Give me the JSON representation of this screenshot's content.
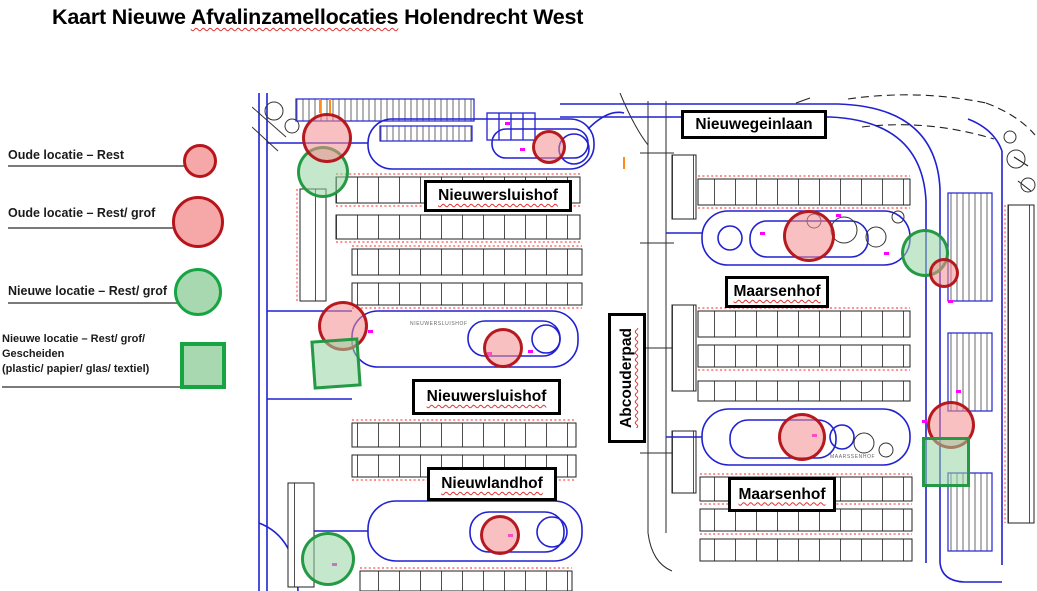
{
  "title": {
    "prefix": "Kaart Nieuwe ",
    "misspelled": "Afvalinzamellocaties",
    "suffix": " Holendrecht West"
  },
  "legend": {
    "items": [
      {
        "label": "Oude locatie – Rest",
        "shape": "circle",
        "size": "small",
        "color": "red"
      },
      {
        "label": "Oude locatie – Rest/ grof",
        "shape": "circle",
        "size": "large",
        "color": "red"
      },
      {
        "label": "Nieuwe locatie – Rest/ grof",
        "shape": "circle",
        "size": "large",
        "color": "green"
      },
      {
        "lines": [
          "Nieuwe locatie – Rest/ grof/",
          "Gescheiden",
          "(plastic/ papier/ glas/ textiel)"
        ],
        "shape": "square",
        "color": "green"
      }
    ]
  },
  "colors": {
    "old_location_stroke": "#b6161b",
    "old_location_fill": "#f6a8a8",
    "new_location_stroke": "#17a544",
    "new_location_fill": "#a8d8b0",
    "road_blue": "#2121d2",
    "dimension_red": "#ff2222",
    "annotation_magenta": "#ff00ff",
    "spellcheck_red": "#e03131"
  },
  "map": {
    "street_labels": [
      {
        "text": "Nieuwegeinlaan",
        "x": 681,
        "y": 110,
        "w": 146,
        "h": 29,
        "misspelled": false,
        "vertical": false
      },
      {
        "text": "Nieuwersluishof",
        "x": 424,
        "y": 180,
        "w": 148,
        "h": 32,
        "misspelled": true,
        "vertical": false
      },
      {
        "text": "Nieuwersluishof",
        "x": 412,
        "y": 379,
        "w": 149,
        "h": 36,
        "misspelled": true,
        "vertical": false
      },
      {
        "text": "Abcouderpad",
        "x": 608,
        "y": 313,
        "w": 38,
        "h": 130,
        "misspelled": true,
        "vertical": true
      },
      {
        "text": "Maarsenhof",
        "x": 725,
        "y": 276,
        "w": 104,
        "h": 32,
        "misspelled": true,
        "vertical": false
      },
      {
        "text": "Nieuwlandhof",
        "x": 427,
        "y": 467,
        "w": 130,
        "h": 34,
        "misspelled": true,
        "vertical": false
      },
      {
        "text": "Maarsenhof",
        "x": 728,
        "y": 477,
        "w": 108,
        "h": 35,
        "misspelled": true,
        "vertical": false
      }
    ],
    "micro_labels": [
      {
        "text": "MAARSSENHOF",
        "x": 830,
        "y": 454
      },
      {
        "text": "NIEUWERSLUISHOF",
        "x": 410,
        "y": 321
      }
    ],
    "markers": [
      {
        "name": "new-location-rest-grof",
        "shape": "circle",
        "color": "green",
        "cx": 323,
        "cy": 172,
        "r": 26
      },
      {
        "name": "old-location-rest-grof",
        "shape": "circle",
        "color": "red",
        "cx": 327,
        "cy": 138,
        "r": 25
      },
      {
        "name": "old-location-rest",
        "shape": "circle",
        "color": "red",
        "cx": 549,
        "cy": 147,
        "r": 17
      },
      {
        "name": "old-location-rest-grof",
        "shape": "circle",
        "color": "red",
        "cx": 809,
        "cy": 236,
        "r": 26
      },
      {
        "name": "new-location-rest-grof",
        "shape": "circle",
        "color": "green",
        "cx": 925,
        "cy": 253,
        "r": 24
      },
      {
        "name": "old-location-rest",
        "shape": "circle",
        "color": "red",
        "cx": 944,
        "cy": 273,
        "r": 15
      },
      {
        "name": "old-location-rest-grof",
        "shape": "circle",
        "color": "red",
        "cx": 343,
        "cy": 326,
        "r": 25
      },
      {
        "name": "new-location-gescheiden",
        "shape": "square",
        "color": "green",
        "x": 312,
        "y": 339,
        "w": 48,
        "h": 49,
        "rotate": -4
      },
      {
        "name": "old-location-rest",
        "shape": "circle",
        "color": "red",
        "cx": 503,
        "cy": 348,
        "r": 20
      },
      {
        "name": "old-location-rest-grof",
        "shape": "circle",
        "color": "red",
        "cx": 802,
        "cy": 437,
        "r": 24
      },
      {
        "name": "old-location-rest-grof",
        "shape": "circle",
        "color": "red",
        "cx": 951,
        "cy": 425,
        "r": 24
      },
      {
        "name": "new-location-gescheiden",
        "shape": "square",
        "color": "green",
        "x": 922,
        "y": 437,
        "w": 48,
        "h": 50
      },
      {
        "name": "old-location-rest",
        "shape": "circle",
        "color": "red",
        "cx": 500,
        "cy": 535,
        "r": 20
      },
      {
        "name": "new-location-rest-grof",
        "shape": "circle",
        "color": "green",
        "cx": 328,
        "cy": 559,
        "r": 27
      }
    ]
  }
}
